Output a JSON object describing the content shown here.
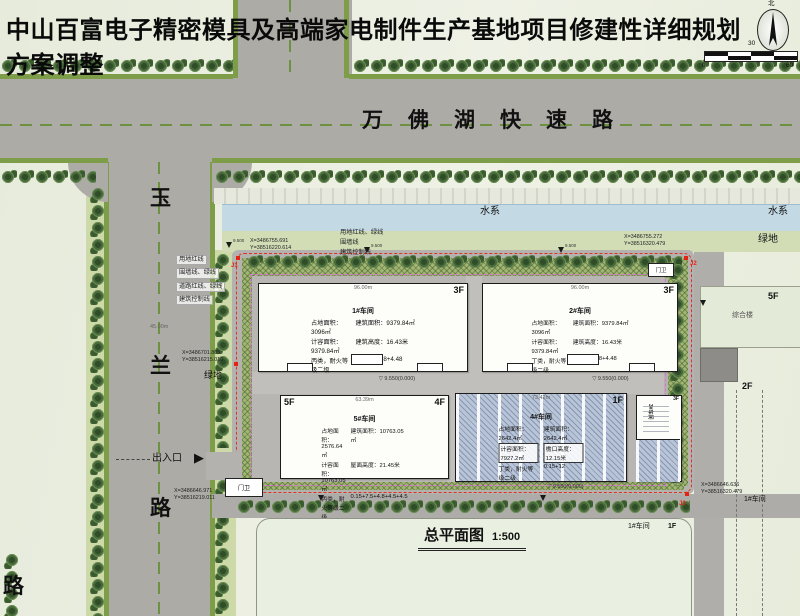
{
  "title": "中山百富电子精密模具及高端家电制件生产基地项目修建性详细规划方案调整",
  "compass": {
    "north": "北"
  },
  "scalebar": {
    "n0": "0",
    "n30": "30",
    "n60": "60"
  },
  "roads": {
    "north_road": "万佛湖快速路",
    "west_road": {
      "c1": "玉",
      "c2": "兰",
      "c3": "路"
    },
    "west_road_width": "45.00m",
    "corner_char": "路"
  },
  "water": {
    "label_a": "水系",
    "label_b": "水系"
  },
  "green": {
    "label_right": "绿地",
    "label_left": "绿地"
  },
  "legend": {
    "left": {
      "l1": "用地红线",
      "l2": "围墙线、绿线",
      "l3": "道路红线、绿线",
      "l4": "建筑控制线"
    },
    "top": {
      "l1": "用地红线、绿线",
      "l2": "围墙线",
      "l3": "建筑控制线"
    }
  },
  "coords": {
    "j1": {
      "label": "J1",
      "x": "X=3486755.691",
      "y": "Y=38516220.614"
    },
    "j2": {
      "label": "J2",
      "x": "X=3486755.272",
      "y": "Y=38516320.479"
    },
    "j3": {
      "label": "J3",
      "x": "X=3486646.636",
      "y": "Y=38516320.479"
    },
    "west": {
      "x": "X=3486701.805",
      "y": "Y=38516215.010"
    },
    "south": {
      "x": "X=3486646.971",
      "y": "Y=38516219.011"
    }
  },
  "buildings": {
    "b1": {
      "name": "1#车间",
      "floor": "3F",
      "dim": "96.00m",
      "r1a": "占地面积：3096㎡",
      "r1b": "建筑面积：9379.84㎡",
      "r2a": "计容面积：9379.84㎡",
      "r2b": "建筑高度：16.43米",
      "r3a": "丙类，耐火等级二级",
      "r3b": "0.15+7+4.8+4.48",
      "level": "9.550(0.000)"
    },
    "b2": {
      "name": "2#车间",
      "floor": "3F",
      "dim": "96.00m",
      "r1a": "占地面积：3096㎡",
      "r1b": "建筑面积：9379.84㎡",
      "r2a": "计容面积：9379.84㎡",
      "r2b": "建筑高度：16.43米",
      "r3a": "丁类，耐火等级二级",
      "r3b": "0.15+7+4.8+4.48",
      "level": "9.550(0.000)"
    },
    "b5": {
      "name": "5#车间",
      "floor_l": "5F",
      "floor_r": "4F",
      "dim": "63.39m",
      "r1a": "占地面积：2576.64㎡",
      "r1b": "建筑面积：10763.05㎡",
      "r2a": "计容面积：10763.05㎡",
      "r2b": "屋面高度：21.45米",
      "r3a": "丙类，耐火等级二级",
      "r3b": "0.15+7.5+4.8+4.5+4.5",
      "level": "9.550(0.000)"
    },
    "b4": {
      "name": "4#车间",
      "floor": "1F",
      "dim": "73.42m",
      "r1a": "占地面积：2642.4㎡",
      "r1b": "建筑面积：2642.4㎡",
      "r2a": "计容面积：7927.2㎡",
      "r2b": "檐口高度：12.15米",
      "r3a": "丁类，耐火等级二级",
      "r3b": "0.15+12",
      "level": "9.550(0.000)"
    },
    "b3": {
      "name": "3#车间",
      "floor": "3F"
    }
  },
  "entrance": {
    "label": "出入口",
    "guard_main": "门卫",
    "guard_ne": "门卫"
  },
  "plan_title": {
    "name": "总平面图",
    "scale": "1:500"
  },
  "neighbors": {
    "east_block": "综合楼",
    "east_block_floor": "5F",
    "east_floor_2": "2F",
    "south_parcel_bldg": "1#车间",
    "south_parcel_floor": "1F",
    "east_far_bldg": "1#车间"
  },
  "marks": {
    "spot": "9.500",
    "tri": "▽",
    "arrow": "▶"
  }
}
